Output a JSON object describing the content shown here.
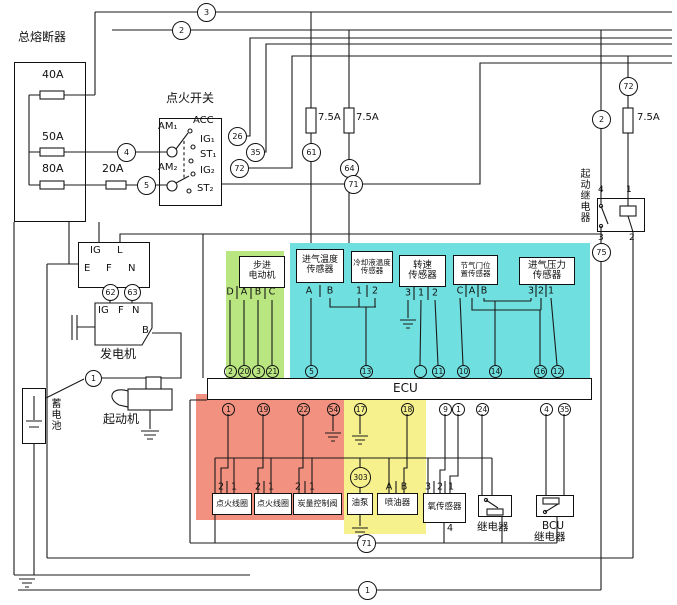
{
  "colors": {
    "region_green": "#b9e681",
    "region_cyan": "#6fe0df",
    "region_red": "#f39180",
    "region_yellow": "#f6f18d",
    "wire": "#1a1a1a"
  },
  "main_fuse_box": {
    "title": "总熔断器",
    "fuse1": "40A",
    "fuse2": "50A",
    "fuse3": "80A"
  },
  "inline_fuse": "20A",
  "ignition_switch": {
    "title": "点火开关",
    "am1": "AM₁",
    "acc": "ACC",
    "ig1": "IG₁",
    "st1": "ST₁",
    "am2": "AM₂",
    "ig2": "IG₂",
    "st2": "ST₂"
  },
  "fuse_75_1": "7.5A",
  "fuse_75_2": "7.5A",
  "fuse_75_3": "7.5A",
  "starter_relay": {
    "title": "起动继电器",
    "pin4": "4",
    "pin1": "1",
    "pin3": "3",
    "pin2": "2"
  },
  "harness_connector": {
    "ig": "IG",
    "l": "L",
    "e": "E",
    "f": "F",
    "n": "N"
  },
  "generator": {
    "title": "发电机",
    "ig": "IG",
    "f": "F",
    "n": "N",
    "b": "B"
  },
  "battery": {
    "title": "蓄电池"
  },
  "starter": {
    "title": "起动机"
  },
  "ecu": {
    "title": "ECU"
  },
  "stepper_motor": {
    "line1": "步进",
    "line2": "电动机"
  },
  "sensors": {
    "intake_temp": {
      "line1": "进气温度",
      "line2": "传感器"
    },
    "coolant_temp": {
      "line1": "冷却液温度",
      "line2": "传感器"
    },
    "speed": {
      "line1": "转速",
      "line2": "传感器"
    },
    "throttle_pos": {
      "line1": "节气门位",
      "line2": "置传感器"
    },
    "map": {
      "line1": "进气压力",
      "line2": "传感器"
    }
  },
  "actuators": {
    "coil1": "点火线圈",
    "coil2": "点火线圈",
    "flow_valve": "炭量控制阀",
    "fuel_pump": "油泵",
    "injector": "喷油器"
  },
  "oxygen_sensor": {
    "title": "氧传感器",
    "pin_bottom": "4"
  },
  "main_relay": {
    "title": "继电器"
  },
  "bcu_relay": {
    "line1": "BCU",
    "line2": "继电器"
  },
  "circles": [
    {
      "t": "3",
      "x": 206,
      "y": 12,
      "r": 9
    },
    {
      "t": "2",
      "x": 181,
      "y": 30,
      "r": 9
    },
    {
      "t": "4",
      "x": 126,
      "y": 152,
      "r": 9
    },
    {
      "t": "5",
      "x": 146,
      "y": 185,
      "r": 9
    },
    {
      "t": "26",
      "x": 237,
      "y": 136,
      "r": 9
    },
    {
      "t": "35",
      "x": 255,
      "y": 152,
      "r": 9
    },
    {
      "t": "72",
      "x": 239,
      "y": 168,
      "r": 9
    },
    {
      "t": "61",
      "x": 311,
      "y": 152,
      "r": 9
    },
    {
      "t": "64",
      "x": 349,
      "y": 168,
      "r": 9
    },
    {
      "t": "71",
      "x": 353,
      "y": 184,
      "r": 9
    },
    {
      "t": "72",
      "x": 628,
      "y": 86,
      "r": 9
    },
    {
      "t": "2",
      "x": 601,
      "y": 119,
      "r": 9
    },
    {
      "t": "75",
      "x": 601,
      "y": 252,
      "r": 9
    },
    {
      "t": "62",
      "x": 110,
      "y": 292,
      "r": 8
    },
    {
      "t": "63",
      "x": 132,
      "y": 292,
      "r": 8
    },
    {
      "t": "1",
      "x": 93,
      "y": 378,
      "r": 8
    },
    {
      "t": "303",
      "x": 360,
      "y": 477,
      "r": 10,
      "cls": "ecu"
    },
    {
      "t": "71",
      "x": 366,
      "y": 543,
      "r": 9
    },
    {
      "t": "1",
      "x": 367,
      "y": 590,
      "r": 9
    },
    {
      "t": "2",
      "x": 230,
      "y": 371,
      "r": 6,
      "cls": "ecu"
    },
    {
      "t": "20",
      "x": 244,
      "y": 371,
      "r": 6,
      "cls": "ecu"
    },
    {
      "t": "3",
      "x": 258,
      "y": 371,
      "r": 6,
      "cls": "ecu"
    },
    {
      "t": "21",
      "x": 272,
      "y": 371,
      "r": 6,
      "cls": "ecu"
    },
    {
      "t": "5",
      "x": 311,
      "y": 371,
      "r": 6,
      "cls": "ecu"
    },
    {
      "t": "13",
      "x": 366,
      "y": 371,
      "r": 6,
      "cls": "ecu"
    },
    {
      "t": "",
      "x": 420,
      "y": 371,
      "r": 6,
      "cls": "ecu"
    },
    {
      "t": "11",
      "x": 438,
      "y": 371,
      "r": 6,
      "cls": "ecu"
    },
    {
      "t": "10",
      "x": 463,
      "y": 371,
      "r": 6,
      "cls": "ecu"
    },
    {
      "t": "14",
      "x": 495,
      "y": 371,
      "r": 6,
      "cls": "ecu"
    },
    {
      "t": "16",
      "x": 540,
      "y": 371,
      "r": 6,
      "cls": "ecu"
    },
    {
      "t": "12",
      "x": 557,
      "y": 371,
      "r": 6,
      "cls": "ecu"
    },
    {
      "t": "1",
      "x": 228,
      "y": 409,
      "r": 6,
      "cls": "ecu"
    },
    {
      "t": "19",
      "x": 263,
      "y": 409,
      "r": 6,
      "cls": "ecu"
    },
    {
      "t": "22",
      "x": 303,
      "y": 409,
      "r": 6,
      "cls": "ecu"
    },
    {
      "t": "54",
      "x": 333,
      "y": 409,
      "r": 6,
      "cls": "ecu"
    },
    {
      "t": "17",
      "x": 360,
      "y": 409,
      "r": 6,
      "cls": "ecu"
    },
    {
      "t": "18",
      "x": 407,
      "y": 409,
      "r": 6,
      "cls": "ecu"
    },
    {
      "t": "9",
      "x": 445,
      "y": 409,
      "r": 6,
      "cls": "ecu"
    },
    {
      "t": "1",
      "x": 458,
      "y": 409,
      "r": 6,
      "cls": "ecu"
    },
    {
      "t": "24",
      "x": 482,
      "y": 409,
      "r": 6,
      "cls": "ecu"
    },
    {
      "t": "4",
      "x": 546,
      "y": 409,
      "r": 6,
      "cls": "ecu"
    },
    {
      "t": "35",
      "x": 564,
      "y": 409,
      "r": 6,
      "cls": "ecu"
    }
  ],
  "pin_labels": [
    {
      "t": "D",
      "x": 230,
      "y": 292
    },
    {
      "t": "A",
      "x": 244,
      "y": 292
    },
    {
      "t": "B",
      "x": 258,
      "y": 292
    },
    {
      "t": "C",
      "x": 272,
      "y": 292
    },
    {
      "t": "A",
      "x": 309,
      "y": 291
    },
    {
      "t": "B",
      "x": 330,
      "y": 291
    },
    {
      "t": "1",
      "x": 359,
      "y": 291
    },
    {
      "t": "2",
      "x": 375,
      "y": 291
    },
    {
      "t": "3",
      "x": 408,
      "y": 293
    },
    {
      "t": "1",
      "x": 421,
      "y": 293
    },
    {
      "t": "2",
      "x": 435,
      "y": 293
    },
    {
      "t": "C",
      "x": 460,
      "y": 291
    },
    {
      "t": "A",
      "x": 472,
      "y": 291
    },
    {
      "t": "B",
      "x": 484,
      "y": 291
    },
    {
      "t": "3",
      "x": 531,
      "y": 291
    },
    {
      "t": "2",
      "x": 541,
      "y": 291
    },
    {
      "t": "1",
      "x": 551,
      "y": 291
    },
    {
      "t": "2",
      "x": 221,
      "y": 487
    },
    {
      "t": "1",
      "x": 234,
      "y": 487
    },
    {
      "t": "2",
      "x": 258,
      "y": 487
    },
    {
      "t": "1",
      "x": 271,
      "y": 487
    },
    {
      "t": "2",
      "x": 298,
      "y": 487
    },
    {
      "t": "1",
      "x": 312,
      "y": 487
    },
    {
      "t": "A",
      "x": 389,
      "y": 487
    },
    {
      "t": "B",
      "x": 404,
      "y": 487
    },
    {
      "t": "3",
      "x": 428,
      "y": 487
    },
    {
      "t": "2",
      "x": 440,
      "y": 487
    },
    {
      "t": "1",
      "x": 451,
      "y": 487
    }
  ]
}
